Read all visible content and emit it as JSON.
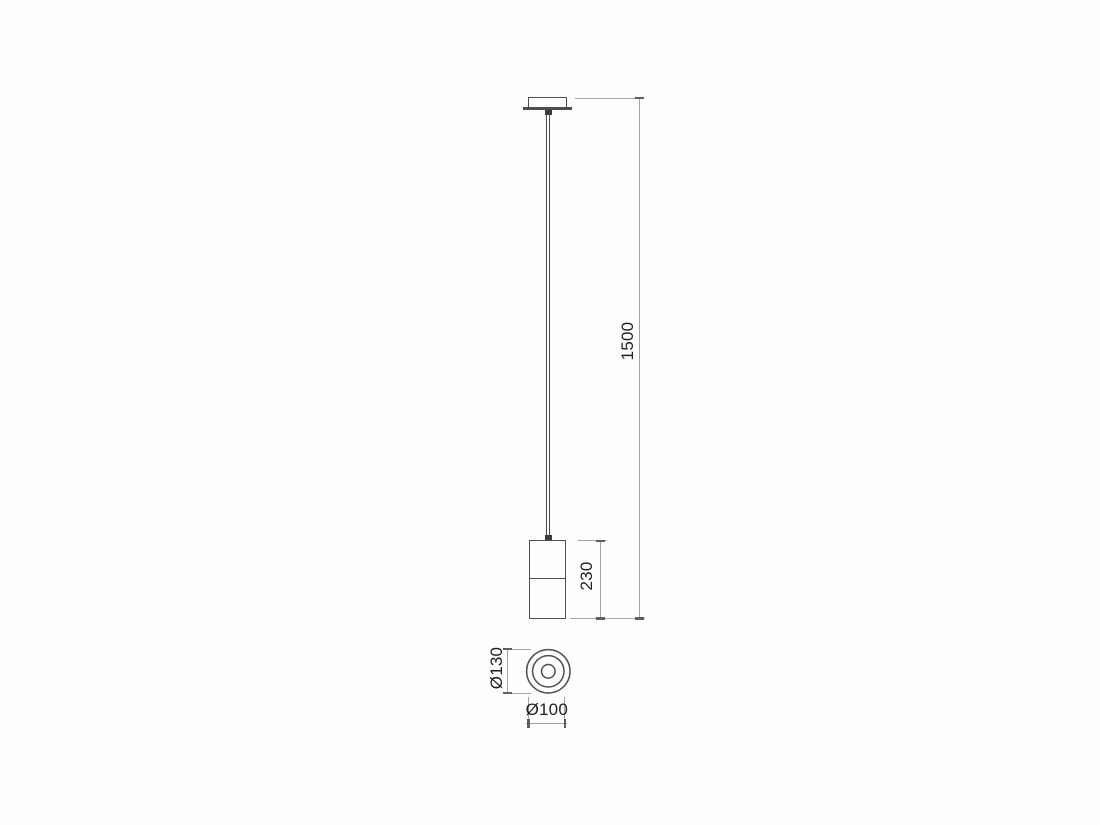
{
  "drawing": {
    "kind": "technical-dimension-diagram",
    "subject": "pendant-lamp-front-and-bottom-view",
    "colors": {
      "object_line": "#4f4f4f",
      "dimension_line": "#a3a3a3",
      "tick": "#5f5f5f",
      "text": "#1f1f1f",
      "background": "#fdfdfd"
    },
    "dimensions": {
      "overall_drop": "1500",
      "body_height": "230",
      "outer_diameter": "Ø130",
      "body_diameter": "Ø100"
    }
  }
}
